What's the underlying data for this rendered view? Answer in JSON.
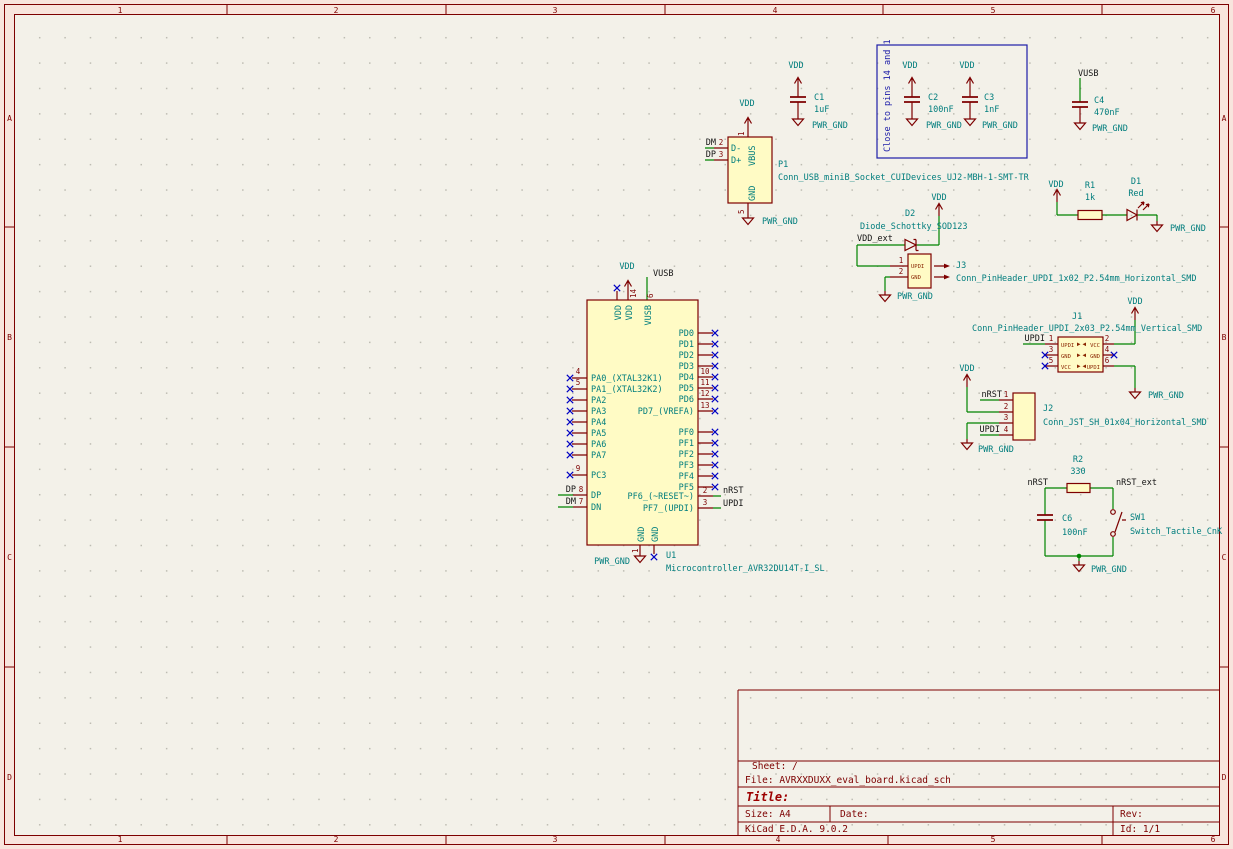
{
  "frame": {
    "cols": [
      "1",
      "2",
      "3",
      "4",
      "5",
      "6"
    ],
    "rows": [
      "A",
      "B",
      "C",
      "D"
    ]
  },
  "title_block": {
    "sheet": "Sheet: /",
    "file": "File: AVRXXDUXX_eval_board.kicad_sch",
    "title": "Title:",
    "size": "Size: A4",
    "date": "Date:",
    "rev": "Rev:",
    "generator": "KiCad E.D.A. 9.0.2",
    "id": "Id: 1/1"
  },
  "power": {
    "vdd": "VDD",
    "gnd": "PWR_GND",
    "vusb": "VUSB"
  },
  "labels": {
    "dm": "DM",
    "dp": "DP",
    "vdd_ext": "VDD_ext",
    "nrst": "nRST",
    "nrst_ext": "nRST_ext",
    "updi": "UPDI",
    "vusb": "VUSB"
  },
  "note": "Close to pins 14 and 1",
  "c1": {
    "ref": "C1",
    "value": "1uF"
  },
  "c2": {
    "ref": "C2",
    "value": "100nF"
  },
  "c3": {
    "ref": "C3",
    "value": "1nF"
  },
  "c4": {
    "ref": "C4",
    "value": "470nF"
  },
  "c6": {
    "ref": "C6",
    "value": "100nF"
  },
  "r1": {
    "ref": "R1",
    "value": "1k"
  },
  "r2": {
    "ref": "R2",
    "value": "330"
  },
  "d1": {
    "ref": "D1",
    "value": "Red"
  },
  "d2": {
    "ref": "D2",
    "value": "Diode_Schottky_SOD123"
  },
  "sw1": {
    "ref": "SW1",
    "value": "Switch_Tactile_CnK"
  },
  "p1": {
    "ref": "P1",
    "value": "Conn_USB_miniB_Socket_CUIDevices_UJ2-MBH-1-SMT-TR",
    "pins": {
      "dm": "D-",
      "dp": "D+",
      "vbus": "VBUS",
      "gnd": "GND"
    },
    "numbers": {
      "vbus": "1",
      "dm": "2",
      "dp": "3",
      "gnd": "5"
    }
  },
  "u1": {
    "ref": "U1",
    "value": "Microcontroller_AVR32DU14T-I_SL",
    "top_names": [
      "VDD",
      "VDD",
      "VUSB"
    ],
    "bottom_names": [
      "GND",
      "GND"
    ],
    "pa": [
      "PA0_(XTAL32K1)",
      "PA1_(XTAL32K2)",
      "PA2",
      "PA3",
      "PA4",
      "PA5",
      "PA6",
      "PA7"
    ],
    "pc3": "PC3",
    "dp": "DP",
    "dn": "DN",
    "pd": [
      "PD0",
      "PD1",
      "PD2",
      "PD3",
      "PD4",
      "PD5",
      "PD6",
      "PD7_(VREFA)"
    ],
    "pf": [
      "PF0",
      "PF1",
      "PF2",
      "PF3",
      "PF4",
      "PF5"
    ],
    "pf6": "PF6_(~RESET~)",
    "pf7": "PF7_(UPDI)",
    "numbers": {
      "pa0": "4",
      "pa1": "5",
      "pc3": "9",
      "dp": "8",
      "dn": "7",
      "pd4": "10",
      "pd5": "11",
      "pd6": "12",
      "pd7": "13",
      "pf6": "2",
      "pf7": "3",
      "vdd": "14",
      "vusb": "6",
      "gnd": "1"
    }
  },
  "j1": {
    "ref": "J1",
    "value": "Conn_PinHeader_UPDI_2x03_P2.54mm_Vertical_SMD",
    "left_names": [
      "UPDI",
      "GND",
      "VCC"
    ],
    "right_names": [
      "VCC",
      "GND",
      "UPDI"
    ],
    "numbers": [
      "1",
      "2",
      "3",
      "4",
      "5",
      "6"
    ]
  },
  "j2": {
    "ref": "J2",
    "value": "Conn_JST_SH_01x04_Horizontal_SMD",
    "numbers": [
      "1",
      "2",
      "3",
      "4"
    ]
  },
  "j3": {
    "ref": "J3",
    "value": "Conn_PinHeader_UPDI_1x02_P2.54mm_Horizontal_SMD",
    "pin_names": [
      "UPDI",
      "GND"
    ],
    "numbers": [
      "1",
      "2"
    ]
  }
}
